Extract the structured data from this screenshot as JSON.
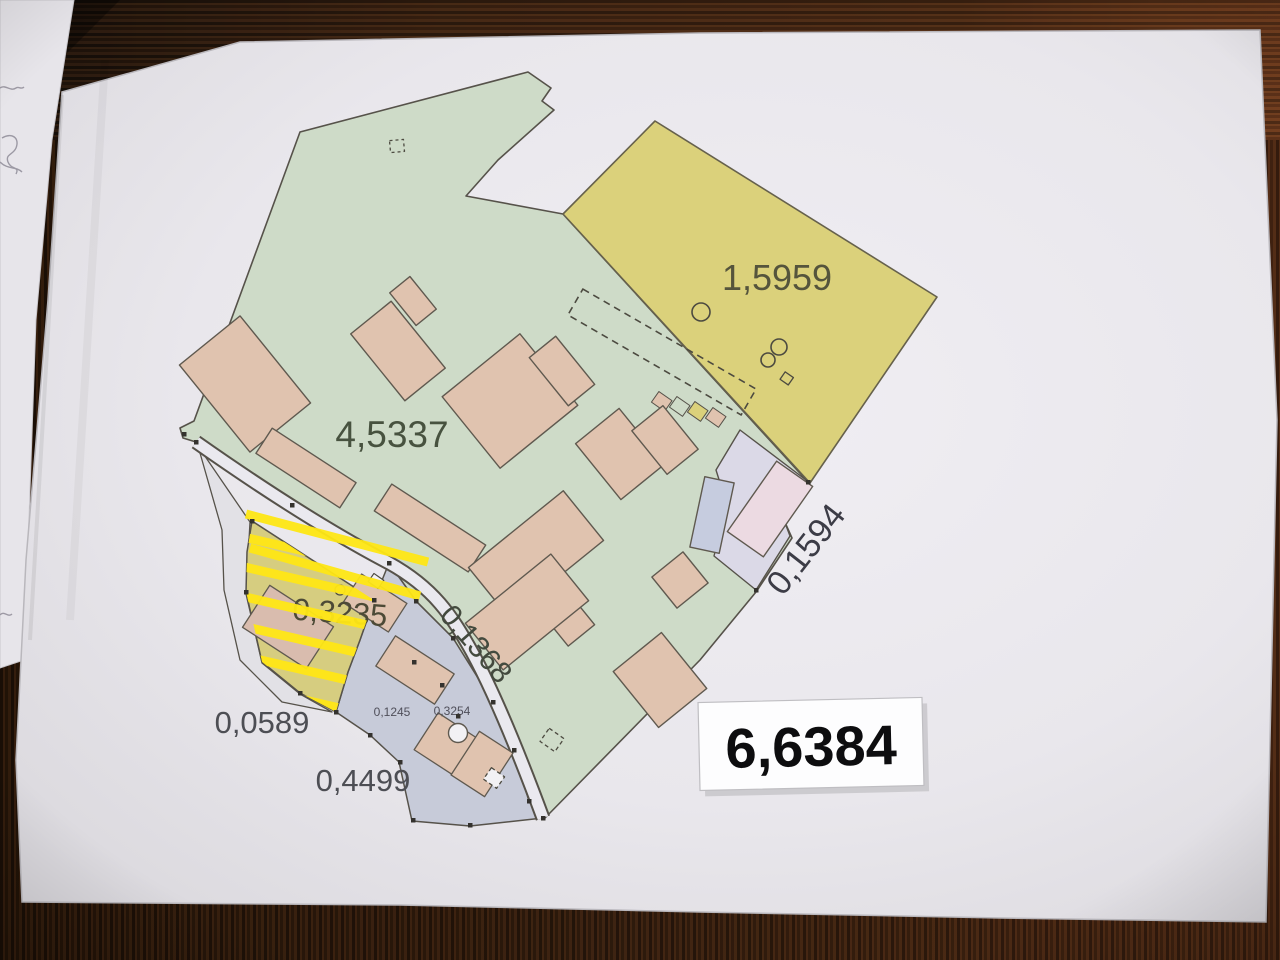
{
  "map": {
    "parcel_labels": {
      "yellow_area": "1,5959",
      "green_area": "4,5337",
      "east_strip_area": "0,1594",
      "road_area": "0,1368",
      "hatched_area": "0,3235",
      "west_area": "0,0589",
      "south_area": "0,4499",
      "small_parcel_left": "0,1245",
      "small_parcel_right": "0,3254"
    },
    "total_area_sticker": "6,6384",
    "colors": {
      "green_parcel": "#cedbc8",
      "yellow_parcel": "#dbd17b",
      "building_pink": "#e0c3af",
      "lavender_parcel": "#dbd9e7",
      "lavender_building": "#ecdae2",
      "blue_building": "#c6ccdf",
      "grey_parcel": "#c7cbd9",
      "road_fill": "#eae9ef",
      "hatch_base": "#d6cd80",
      "hatch_stripe": "#ffe715",
      "outline": "#56524a",
      "paper": "#e9e7ec"
    }
  }
}
